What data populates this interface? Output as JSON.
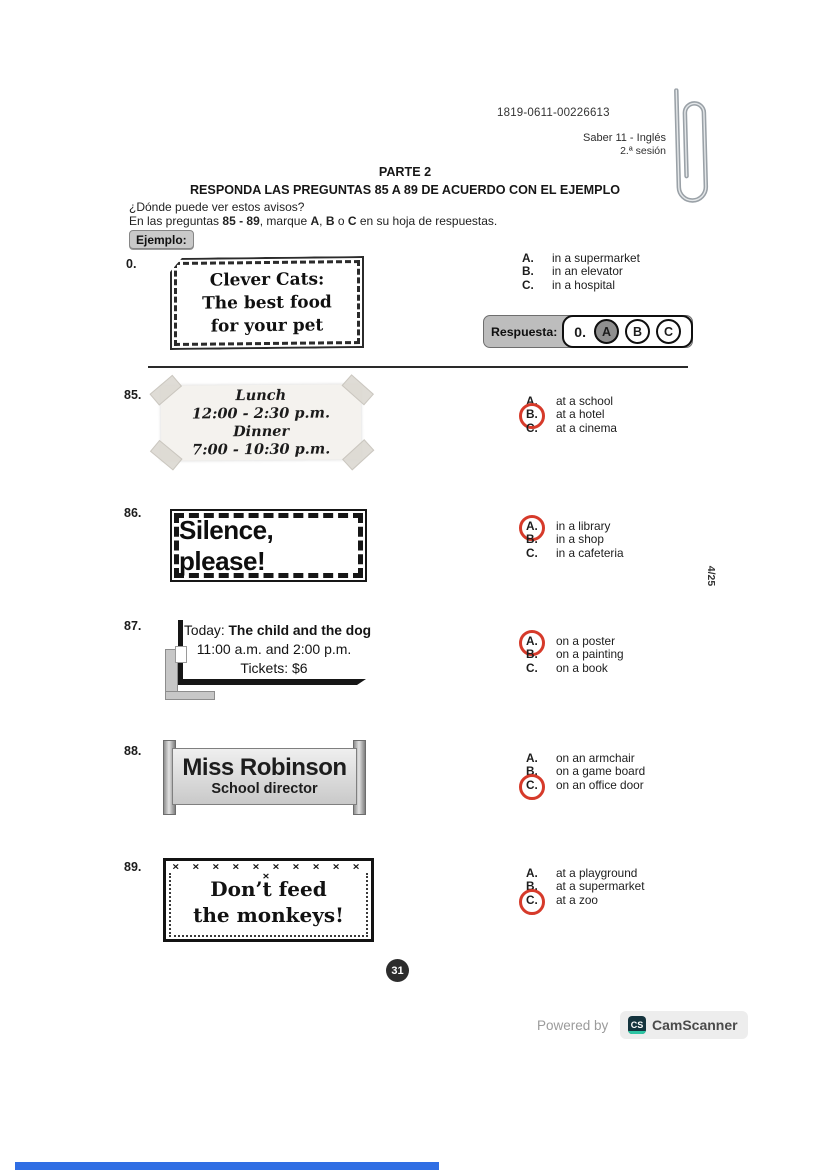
{
  "header": {
    "code": "1819-0611-00226613",
    "exam_name": "Saber 11 - Inglés",
    "session": "2.ª sesión"
  },
  "heading": {
    "part": "PARTE 2",
    "instruction": "RESPONDA LAS PREGUNTAS 85 A 89 DE ACUERDO CON EL EJEMPLO",
    "prompt": "¿Dónde puede ver estos avisos?",
    "directions_parts": {
      "p0": "En las preguntas ",
      "b0": "85 - 89",
      "p1": ", marque ",
      "b1": "A",
      "p2": ", ",
      "b2": "B",
      "p3": " o ",
      "b3": "C",
      "p4": " en su hoja de respuestas.",
      "example_label": "Ejemplo:"
    }
  },
  "example": {
    "number": "0.",
    "sign_lines": [
      "Clever Cats:",
      "The best food",
      "for your pet"
    ],
    "options": [
      {
        "letter": "A.",
        "text": "in a supermarket"
      },
      {
        "letter": "B.",
        "text": "in an elevator"
      },
      {
        "letter": "C.",
        "text": "in a hospital"
      }
    ],
    "answer": {
      "label": "Respuesta:",
      "number": "0.",
      "choices": [
        "A",
        "B",
        "C"
      ],
      "selected": "A"
    }
  },
  "questions": [
    {
      "number": "85.",
      "sign_style": "taped-paper",
      "sign_lines": [
        "Lunch",
        "12:00 - 2:30 p.m.",
        "Dinner",
        "7:00 - 10:30 p.m."
      ],
      "options": [
        {
          "letter": "A.",
          "text": "at a school",
          "circled": false
        },
        {
          "letter": "B.",
          "text": "at a hotel",
          "circled": true
        },
        {
          "letter": "C.",
          "text": "at a cinema",
          "circled": false
        }
      ]
    },
    {
      "number": "86.",
      "sign_style": "framed",
      "sign_lines": [
        "Silence, please!"
      ],
      "options": [
        {
          "letter": "A.",
          "text": "in a library",
          "circled": true
        },
        {
          "letter": "B.",
          "text": "in a shop",
          "circled": false
        },
        {
          "letter": "C.",
          "text": "in a cafeteria",
          "circled": false
        }
      ]
    },
    {
      "number": "87.",
      "sign_style": "stand",
      "sign_prefix": "Today: ",
      "sign_title": "The child and the dog",
      "sign_lines": [
        "11:00 a.m. and 2:00 p.m.",
        "Tickets: $6"
      ],
      "options": [
        {
          "letter": "A.",
          "text": "on a poster",
          "circled": true
        },
        {
          "letter": "B.",
          "text": "on a painting",
          "circled": false
        },
        {
          "letter": "C.",
          "text": "on a book",
          "circled": false
        }
      ]
    },
    {
      "number": "88.",
      "sign_style": "nameplate",
      "sign_lines": [
        "Miss Robinson",
        "School director"
      ],
      "options": [
        {
          "letter": "A.",
          "text": "on an armchair",
          "circled": false
        },
        {
          "letter": "B.",
          "text": "on a game board",
          "circled": false
        },
        {
          "letter": "C.",
          "text": "on an office door",
          "circled": true
        }
      ]
    },
    {
      "number": "89.",
      "sign_style": "stamp-border",
      "sign_ornament": "✕ ✕ ✕ ✕ ✕ ✕ ✕ ✕ ✕ ✕ ✕",
      "sign_lines": [
        "Don’t feed",
        "the monkeys!"
      ],
      "options": [
        {
          "letter": "A.",
          "text": "at a playground",
          "circled": false
        },
        {
          "letter": "B.",
          "text": "at a supermarket",
          "circled": false
        },
        {
          "letter": "C.",
          "text": "at a zoo",
          "circled": true
        }
      ]
    }
  ],
  "side_label": "4/25",
  "page_number": "31",
  "footer": {
    "powered_by": "Powered by",
    "logo_text": "CS",
    "brand": "CamScanner"
  },
  "colors": {
    "answer_circle_red": "#d63a2a",
    "respuesta_label_bg": "#bdbdbd",
    "selected_bubble_fill": "#8f8f8f",
    "page_badge_bg": "#2d2d2d",
    "camscanner_teal": "#2ec5a4",
    "bottom_bar_blue": "#2f6ee4"
  }
}
